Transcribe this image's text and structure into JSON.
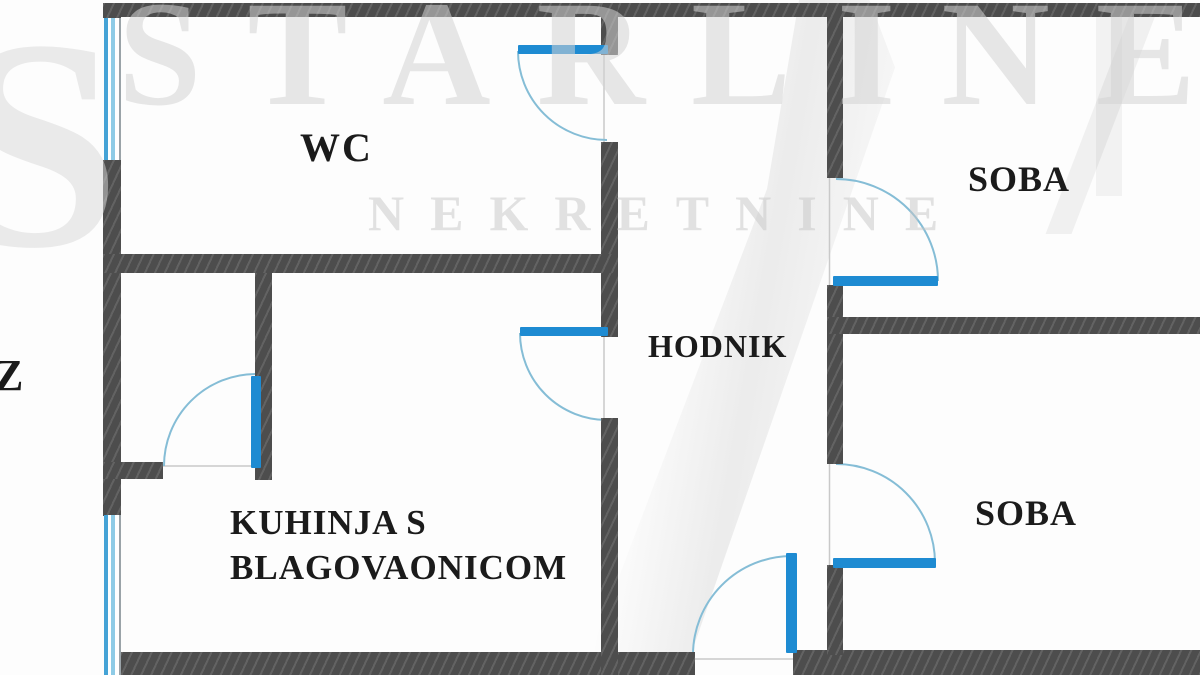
{
  "plan_title": "apartment floor plan",
  "labels": {
    "wc": "WC",
    "hodnik": "HODNIK",
    "soba_top": "SOBA",
    "soba_bottom": "SOBA",
    "kitchen_line1": "KUHINJA S",
    "kitchen_line2": "BLAGOVAONICOM",
    "edge_partial": "Z"
  },
  "rooms": [
    "WC",
    "HODNIK",
    "SOBA",
    "SOBA",
    "KUHINJA S BLAGOVAONICOM"
  ],
  "watermark": {
    "brand_line1": "STARLINE",
    "brand_initial": "S",
    "brand_line2": "NEKRETNINE"
  },
  "colors": {
    "wall": "#4d4d4d",
    "door": "#1e8bd2",
    "window-line": "#45a3d6",
    "window-line2": "#8ecbe6",
    "arc": "#85bdd6",
    "jamb": "#c9c9c9",
    "label": "#1b1b1b"
  }
}
